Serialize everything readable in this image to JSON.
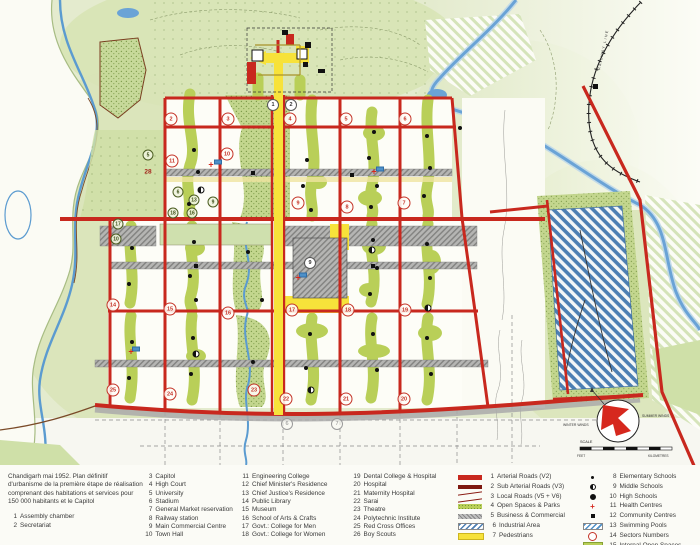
{
  "legend": {
    "intro": "Chandigarh mai 1952. Plan définitif d'urbanisme de la première étape de réalisation comprenant des habitations et services pour 150 000 habitants et le Capitol",
    "numbered": [
      {
        "n": 1,
        "label": "Assembly chamber"
      },
      {
        "n": 2,
        "label": "Secretariat"
      },
      {
        "n": 3,
        "label": "Capitol"
      },
      {
        "n": 4,
        "label": "High Court"
      },
      {
        "n": 5,
        "label": "University"
      },
      {
        "n": 6,
        "label": "Stadium"
      },
      {
        "n": 7,
        "label": "General Market reservation"
      },
      {
        "n": 8,
        "label": "Railway station"
      },
      {
        "n": 9,
        "label": "Main Commercial Centre"
      },
      {
        "n": 10,
        "label": "Town Hall"
      },
      {
        "n": 11,
        "label": "Engineering College"
      },
      {
        "n": 12,
        "label": "Chief Minister's Residence"
      },
      {
        "n": 13,
        "label": "Chief Justice's Residence"
      },
      {
        "n": 14,
        "label": "Public Library"
      },
      {
        "n": 15,
        "label": "Museum"
      },
      {
        "n": 16,
        "label": "School of Arts & Crafts"
      },
      {
        "n": 17,
        "label": "Govt.: College for Men"
      },
      {
        "n": 18,
        "label": "Govt.: College for Women"
      },
      {
        "n": 19,
        "label": "Dental College & Hospital"
      },
      {
        "n": 20,
        "label": "Hospital"
      },
      {
        "n": 21,
        "label": "Maternity Hospital"
      },
      {
        "n": 22,
        "label": "Sarai"
      },
      {
        "n": 23,
        "label": "Theatre"
      },
      {
        "n": 24,
        "label": "Polytechnic Institute"
      },
      {
        "n": 25,
        "label": "Red Cross Offices"
      },
      {
        "n": 26,
        "label": "Boy Scouts"
      }
    ],
    "road_items": [
      {
        "n": 1,
        "label": "Arterial Roads (V2)",
        "swatch": "arterial"
      },
      {
        "n": 2,
        "label": "Sub Arterial Roads (V3)",
        "swatch": "subarterial"
      },
      {
        "n": 3,
        "label": "Local Roads (V5 + V6)",
        "swatch": "local"
      },
      {
        "n": 4,
        "label": "Open Spaces & Parks",
        "swatch": "open"
      },
      {
        "n": 5,
        "label": "Business & Commercial",
        "swatch": "business"
      },
      {
        "n": 6,
        "label": "Industrial Area",
        "swatch": "industrial"
      },
      {
        "n": 7,
        "label": "Pedestrians",
        "swatch": "pedestrian"
      }
    ],
    "symbol_items": [
      {
        "n": 8,
        "label": "Elementary Schools",
        "glyph": "dot-s"
      },
      {
        "n": 9,
        "label": "Middle Schools",
        "glyph": "half"
      },
      {
        "n": 10,
        "label": "High Schools",
        "glyph": "dot-h"
      },
      {
        "n": 11,
        "label": "Health Centres",
        "glyph": "cross"
      },
      {
        "n": 12,
        "label": "Community Centres",
        "glyph": "square"
      },
      {
        "n": 13,
        "label": "Swimming Pools",
        "glyph": "pools"
      },
      {
        "n": 14,
        "label": "Sectors Numbers",
        "glyph": "circle"
      },
      {
        "n": 15,
        "label": "Internal Open Spaces",
        "glyph": "internal"
      }
    ]
  },
  "map": {
    "railway_label": "RAILWAY LINE",
    "compass": {
      "scale_label": "SCALE",
      "wind_left": "WINTER WINDS",
      "wind_right": "SUMMER WINDS",
      "unit_left": "FEET",
      "unit_right": "KILOMETRES"
    },
    "sector_numbers": [
      {
        "n": "2",
        "x": 171,
        "y": 119
      },
      {
        "n": "3",
        "x": 228,
        "y": 119
      },
      {
        "n": "4",
        "x": 290,
        "y": 119
      },
      {
        "n": "5",
        "x": 346,
        "y": 119
      },
      {
        "n": "6",
        "x": 405,
        "y": 119
      },
      {
        "n": "7",
        "x": 404,
        "y": 203
      },
      {
        "n": "8",
        "x": 347,
        "y": 207
      },
      {
        "n": "9",
        "x": 298,
        "y": 203
      },
      {
        "n": "10",
        "x": 227,
        "y": 154
      },
      {
        "n": "11",
        "x": 172,
        "y": 161
      },
      {
        "n": "14",
        "x": 113,
        "y": 305
      },
      {
        "n": "15",
        "x": 170,
        "y": 309
      },
      {
        "n": "16",
        "x": 228,
        "y": 313
      },
      {
        "n": "17",
        "x": 292,
        "y": 310
      },
      {
        "n": "18",
        "x": 348,
        "y": 310
      },
      {
        "n": "19",
        "x": 405,
        "y": 310
      },
      {
        "n": "20",
        "x": 404,
        "y": 399
      },
      {
        "n": "21",
        "x": 346,
        "y": 399
      },
      {
        "n": "22",
        "x": 286,
        "y": 399
      },
      {
        "n": "23",
        "x": 254,
        "y": 390
      },
      {
        "n": "24",
        "x": 170,
        "y": 394
      },
      {
        "n": "25",
        "x": 113,
        "y": 390
      }
    ],
    "facility_numbers": [
      {
        "n": "5",
        "x": 148,
        "y": 155
      },
      {
        "n": "6",
        "x": 178,
        "y": 192
      },
      {
        "n": "13",
        "x": 194,
        "y": 200
      },
      {
        "n": "9",
        "x": 213,
        "y": 202
      },
      {
        "n": "16",
        "x": 192,
        "y": 213
      },
      {
        "n": "18",
        "x": 173,
        "y": 213
      },
      {
        "n": "17",
        "x": 118,
        "y": 224
      },
      {
        "n": "10",
        "x": 116,
        "y": 239
      }
    ],
    "white_circles": [
      {
        "n": "1",
        "x": 273,
        "y": 105
      },
      {
        "n": "2",
        "x": 291,
        "y": 105
      },
      {
        "n": "9",
        "x": 310,
        "y": 263
      }
    ],
    "gray_circles": [
      {
        "n": "6",
        "x": 287,
        "y": 424
      },
      {
        "n": "7",
        "x": 337,
        "y": 424
      }
    ],
    "area_label": {
      "text": "28",
      "x": 148,
      "y": 172
    },
    "schools": [
      {
        "x": 194,
        "y": 150
      },
      {
        "x": 198,
        "y": 172
      },
      {
        "x": 189,
        "y": 204
      },
      {
        "x": 307,
        "y": 160
      },
      {
        "x": 303,
        "y": 186
      },
      {
        "x": 311,
        "y": 210
      },
      {
        "x": 374,
        "y": 132
      },
      {
        "x": 369,
        "y": 158
      },
      {
        "x": 377,
        "y": 186
      },
      {
        "x": 371,
        "y": 207
      },
      {
        "x": 427,
        "y": 136
      },
      {
        "x": 430,
        "y": 168
      },
      {
        "x": 424,
        "y": 196
      },
      {
        "x": 132,
        "y": 248
      },
      {
        "x": 129,
        "y": 284
      },
      {
        "x": 194,
        "y": 242
      },
      {
        "x": 190,
        "y": 276
      },
      {
        "x": 196,
        "y": 300
      },
      {
        "x": 248,
        "y": 252
      },
      {
        "x": 262,
        "y": 300
      },
      {
        "x": 373,
        "y": 240
      },
      {
        "x": 377,
        "y": 268
      },
      {
        "x": 370,
        "y": 294
      },
      {
        "x": 427,
        "y": 244
      },
      {
        "x": 430,
        "y": 278
      },
      {
        "x": 132,
        "y": 342
      },
      {
        "x": 129,
        "y": 378
      },
      {
        "x": 193,
        "y": 338
      },
      {
        "x": 191,
        "y": 374
      },
      {
        "x": 310,
        "y": 334
      },
      {
        "x": 306,
        "y": 368
      },
      {
        "x": 373,
        "y": 334
      },
      {
        "x": 377,
        "y": 370
      },
      {
        "x": 427,
        "y": 338
      },
      {
        "x": 431,
        "y": 374
      },
      {
        "x": 253,
        "y": 362
      },
      {
        "x": 460,
        "y": 128
      }
    ],
    "middle_schools": [
      {
        "x": 201,
        "y": 190
      },
      {
        "x": 372,
        "y": 250
      },
      {
        "x": 196,
        "y": 354
      },
      {
        "x": 428,
        "y": 308
      },
      {
        "x": 311,
        "y": 390
      }
    ],
    "community_centres": [
      {
        "x": 253,
        "y": 173
      },
      {
        "x": 352,
        "y": 175
      },
      {
        "x": 196,
        "y": 266
      },
      {
        "x": 373,
        "y": 266
      }
    ],
    "health_centres": [
      {
        "x": 211,
        "y": 165
      },
      {
        "x": 374,
        "y": 172
      },
      {
        "x": 298,
        "y": 278
      },
      {
        "x": 131,
        "y": 352
      }
    ],
    "swimming_pools": [
      {
        "x": 218,
        "y": 162
      },
      {
        "x": 380,
        "y": 169
      },
      {
        "x": 303,
        "y": 275
      },
      {
        "x": 136,
        "y": 349
      }
    ]
  },
  "colors": {
    "arterial_red": "#c8281e",
    "sub_arterial_red": "#7e1810",
    "pedestrian_yellow": "#f7e23a",
    "open_space_green": "#b9cf58",
    "commercial_gray": "#9d9d9d",
    "industrial_blue": "#4c7fb3",
    "water_blue": "#5b9bd0",
    "background_green": "#dce7c2"
  }
}
